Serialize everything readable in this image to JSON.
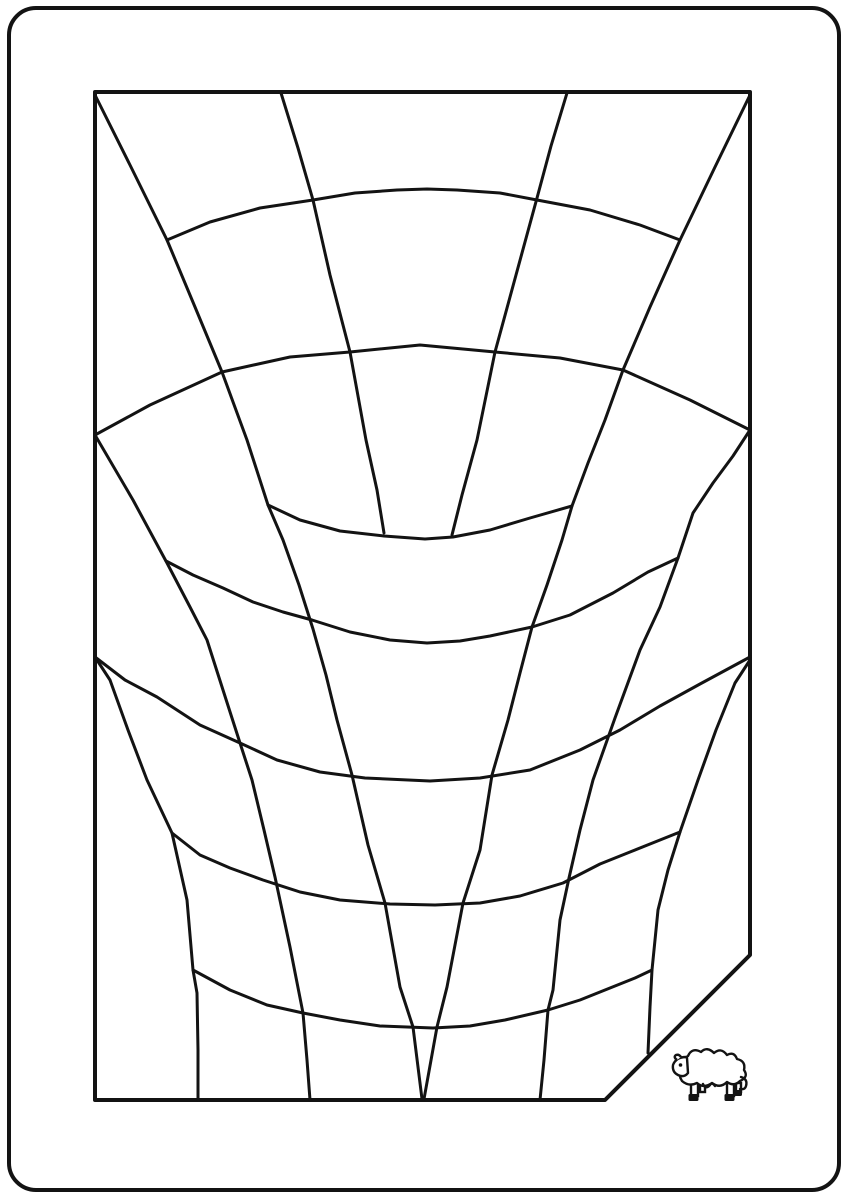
{
  "canvas": {
    "width": 848,
    "height": 1200,
    "background_color": "#ffffff",
    "line_color": "#131313"
  },
  "outer_border": {
    "x": 9,
    "y": 8,
    "width": 830,
    "height": 1182,
    "corner_radius": 27,
    "stroke_width": 4
  },
  "inner_frame": {
    "comment_shape": "rectangle with bottom-right corner cut by a diagonal",
    "points": [
      [
        95,
        92
      ],
      [
        750,
        92
      ],
      [
        750,
        955
      ],
      [
        605,
        1100
      ],
      [
        95,
        1100
      ]
    ],
    "stroke_width": 4
  },
  "strokes": [
    {
      "name": "ray-top-left-corner",
      "width": 3,
      "points": [
        [
          95,
          95
        ],
        [
          130,
          165
        ],
        [
          167,
          240
        ],
        [
          195,
          307
        ],
        [
          222,
          372
        ],
        [
          247,
          440
        ],
        [
          268,
          505
        ],
        [
          283,
          540
        ],
        [
          299,
          585
        ],
        [
          313,
          629
        ],
        [
          326,
          675
        ],
        [
          337,
          720
        ],
        [
          352,
          775
        ],
        [
          368,
          845
        ],
        [
          385,
          903
        ],
        [
          400,
          987
        ],
        [
          413,
          1027
        ],
        [
          422,
          1099
        ]
      ]
    },
    {
      "name": "ray-top-right-corner",
      "width": 3,
      "points": [
        [
          750,
          95
        ],
        [
          715,
          167
        ],
        [
          680,
          240
        ],
        [
          650,
          307
        ],
        [
          623,
          370
        ],
        [
          605,
          420
        ],
        [
          588,
          463
        ],
        [
          572,
          506
        ],
        [
          562,
          540
        ],
        [
          547,
          585
        ],
        [
          532,
          627
        ],
        [
          520,
          673
        ],
        [
          508,
          720
        ],
        [
          492,
          775
        ],
        [
          480,
          850
        ],
        [
          463,
          903
        ],
        [
          447,
          987
        ],
        [
          437,
          1027
        ],
        [
          424,
          1099
        ]
      ]
    },
    {
      "name": "ray-top-inner-left",
      "width": 3,
      "points": [
        [
          281,
          93
        ],
        [
          298,
          148
        ],
        [
          313,
          200
        ],
        [
          330,
          275
        ],
        [
          350,
          352
        ],
        [
          366,
          440
        ],
        [
          377,
          490
        ],
        [
          384,
          533
        ]
      ]
    },
    {
      "name": "ray-top-inner-right",
      "width": 3,
      "points": [
        [
          567,
          93
        ],
        [
          551,
          146
        ],
        [
          537,
          198
        ],
        [
          516,
          275
        ],
        [
          495,
          352
        ],
        [
          477,
          440
        ],
        [
          462,
          495
        ],
        [
          452,
          535
        ]
      ]
    },
    {
      "name": "ray-mid-left-edge",
      "width": 3,
      "points": [
        [
          95,
          435
        ],
        [
          133,
          500
        ],
        [
          167,
          563
        ],
        [
          190,
          607
        ],
        [
          207,
          640
        ],
        [
          223,
          690
        ],
        [
          240,
          743
        ],
        [
          252,
          780
        ],
        [
          264,
          830
        ],
        [
          275,
          877
        ],
        [
          290,
          947
        ],
        [
          303,
          1013
        ],
        [
          307,
          1060
        ],
        [
          310,
          1100
        ]
      ]
    },
    {
      "name": "ray-mid-right-edge",
      "width": 3,
      "points": [
        [
          750,
          430
        ],
        [
          733,
          456
        ],
        [
          713,
          483
        ],
        [
          693,
          513
        ],
        [
          678,
          558
        ],
        [
          660,
          607
        ],
        [
          640,
          650
        ],
        [
          615,
          718
        ],
        [
          593,
          780
        ],
        [
          580,
          830
        ],
        [
          569,
          878
        ],
        [
          560,
          920
        ],
        [
          553,
          990
        ],
        [
          548,
          1010
        ],
        [
          544,
          1060
        ],
        [
          540,
          1100
        ]
      ]
    },
    {
      "name": "ray-low-left-edge",
      "width": 3,
      "points": [
        [
          95,
          657
        ],
        [
          110,
          680
        ],
        [
          128,
          730
        ],
        [
          147,
          780
        ],
        [
          172,
          833
        ],
        [
          187,
          900
        ],
        [
          193,
          970
        ],
        [
          197,
          993
        ],
        [
          198,
          1050
        ],
        [
          198,
          1100
        ]
      ]
    },
    {
      "name": "ray-low-right-edge",
      "width": 3,
      "points": [
        [
          750,
          660
        ],
        [
          735,
          683
        ],
        [
          716,
          730
        ],
        [
          698,
          780
        ],
        [
          680,
          832
        ],
        [
          668,
          870
        ],
        [
          658,
          910
        ],
        [
          652,
          970
        ],
        [
          650,
          1007
        ],
        [
          648,
          1053
        ]
      ]
    },
    {
      "name": "arc-bulge-upper",
      "width": 3,
      "points": [
        [
          167,
          240
        ],
        [
          210,
          222
        ],
        [
          260,
          208
        ],
        [
          313,
          200
        ],
        [
          355,
          193
        ],
        [
          397,
          190
        ],
        [
          427,
          189
        ],
        [
          457,
          190
        ],
        [
          500,
          193
        ],
        [
          537,
          200
        ],
        [
          590,
          210
        ],
        [
          640,
          225
        ],
        [
          680,
          240
        ]
      ]
    },
    {
      "name": "arc-bulge-wide",
      "width": 3,
      "points": [
        [
          95,
          435
        ],
        [
          150,
          405
        ],
        [
          222,
          372
        ],
        [
          290,
          357
        ],
        [
          350,
          352
        ],
        [
          420,
          345
        ],
        [
          495,
          352
        ],
        [
          560,
          358
        ],
        [
          623,
          370
        ],
        [
          690,
          400
        ],
        [
          750,
          430
        ]
      ]
    },
    {
      "name": "arc-dip-1",
      "width": 3,
      "points": [
        [
          268,
          505
        ],
        [
          300,
          520
        ],
        [
          340,
          531
        ],
        [
          384,
          536
        ],
        [
          425,
          539
        ],
        [
          453,
          537
        ],
        [
          490,
          530
        ],
        [
          530,
          518
        ],
        [
          572,
          506
        ]
      ]
    },
    {
      "name": "arc-dip-2",
      "width": 3,
      "points": [
        [
          166,
          561
        ],
        [
          193,
          575
        ],
        [
          223,
          588
        ],
        [
          253,
          602
        ],
        [
          283,
          612
        ],
        [
          312,
          620
        ],
        [
          350,
          632
        ],
        [
          390,
          640
        ],
        [
          427,
          643
        ],
        [
          460,
          641
        ],
        [
          490,
          636
        ],
        [
          532,
          627
        ],
        [
          570,
          615
        ],
        [
          613,
          593
        ],
        [
          648,
          572
        ],
        [
          678,
          558
        ]
      ]
    },
    {
      "name": "arc-dip-3",
      "width": 3,
      "points": [
        [
          95,
          657
        ],
        [
          125,
          680
        ],
        [
          157,
          697
        ],
        [
          200,
          725
        ],
        [
          240,
          743
        ],
        [
          277,
          760
        ],
        [
          320,
          772
        ],
        [
          365,
          778
        ],
        [
          430,
          781
        ],
        [
          480,
          778
        ],
        [
          530,
          770
        ],
        [
          580,
          750
        ],
        [
          620,
          730
        ],
        [
          660,
          706
        ],
        [
          700,
          684
        ],
        [
          750,
          657
        ]
      ]
    },
    {
      "name": "arc-dip-4",
      "width": 3,
      "points": [
        [
          172,
          833
        ],
        [
          200,
          855
        ],
        [
          230,
          868
        ],
        [
          263,
          880
        ],
        [
          300,
          892
        ],
        [
          340,
          900
        ],
        [
          390,
          904
        ],
        [
          435,
          905
        ],
        [
          480,
          903
        ],
        [
          520,
          896
        ],
        [
          563,
          883
        ],
        [
          600,
          864
        ],
        [
          630,
          852
        ],
        [
          660,
          840
        ],
        [
          680,
          832
        ]
      ]
    },
    {
      "name": "arc-dip-5",
      "width": 3,
      "points": [
        [
          193,
          970
        ],
        [
          230,
          990
        ],
        [
          267,
          1005
        ],
        [
          303,
          1013
        ],
        [
          340,
          1020
        ],
        [
          380,
          1026
        ],
        [
          433,
          1028
        ],
        [
          470,
          1026
        ],
        [
          505,
          1020
        ],
        [
          548,
          1010
        ],
        [
          580,
          1000
        ],
        [
          610,
          988
        ],
        [
          635,
          978
        ],
        [
          652,
          970
        ]
      ]
    }
  ],
  "sheep": {
    "name": "sheep-icon",
    "x": 670,
    "y": 1045,
    "width": 82,
    "height": 58,
    "facing": "left",
    "stroke_width": 2.4
  }
}
